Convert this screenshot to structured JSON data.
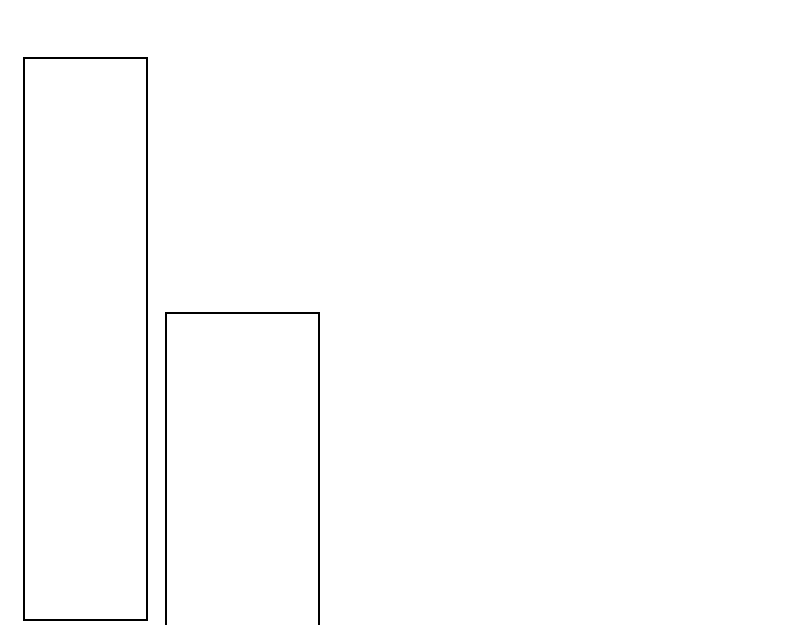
{
  "page": {
    "background_color": "#ffffff",
    "width_px": 800,
    "height_px": 625
  },
  "chart_data": {
    "type": "bar",
    "title": "",
    "xlabel": "",
    "ylabel": "",
    "categories": [
      "bar-1",
      "bar-2"
    ],
    "values": [
      564,
      313
    ],
    "axes_visible": false,
    "grid": false,
    "legend": false,
    "bar_style": {
      "fill": "#ffffff",
      "stroke": "#000000",
      "stroke_width_px": 2
    },
    "bars": [
      {
        "name": "bar-1",
        "x_px": 23,
        "y_px": 57,
        "width_px": 125,
        "height_px": 564,
        "clipped_bottom": false
      },
      {
        "name": "bar-2",
        "x_px": 165,
        "y_px": 312,
        "width_px": 155,
        "height_px": 326,
        "clipped_bottom": true
      }
    ]
  }
}
